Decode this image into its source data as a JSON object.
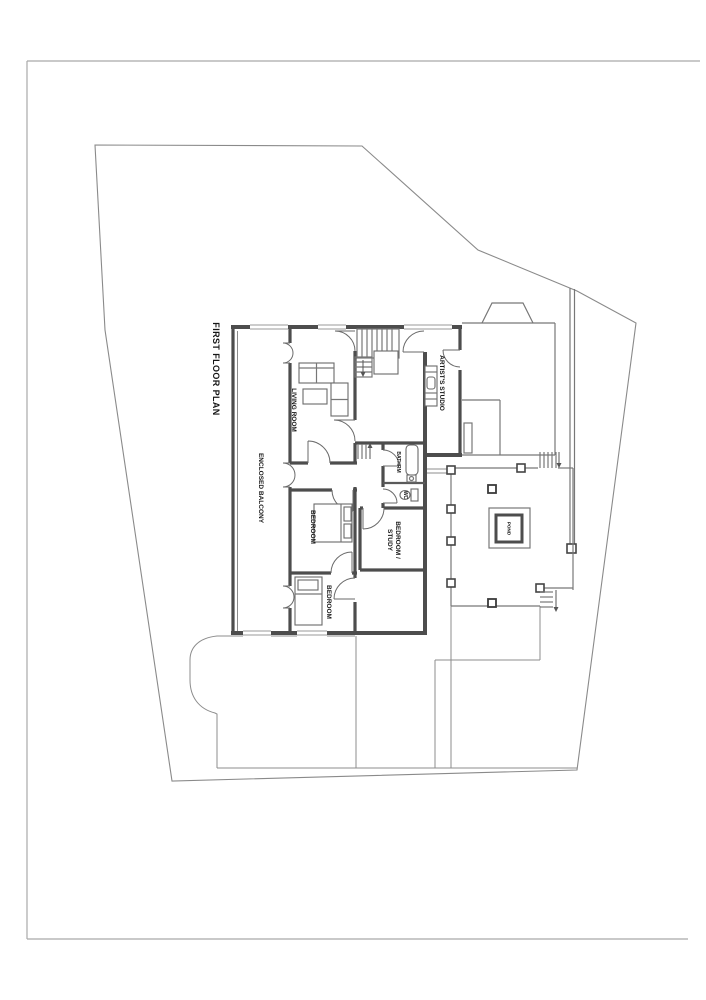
{
  "page": {
    "title": "FIRST FLOOR PLAN"
  },
  "rooms": {
    "enclosed_balcony": "ENCLOSED BALCONY",
    "living_room": "LIVING ROOM",
    "artists_studio": "ARTIST'S STUDIO",
    "bathroom": "BATHRM",
    "wc": "WC",
    "bedroom_1": "BEDROOM",
    "bedroom_study_line1": "BEDROOM /",
    "bedroom_study_line2": "STUDY",
    "bedroom_2": "BEDROOM",
    "pond": "POND"
  },
  "colors": {
    "background": "#ffffff",
    "wall": "#4d4d4d",
    "thin_line": "#8c8c8c",
    "site_boundary": "#8a8a8a",
    "page_border": "#a9a9a9",
    "label_text": "#161616"
  }
}
